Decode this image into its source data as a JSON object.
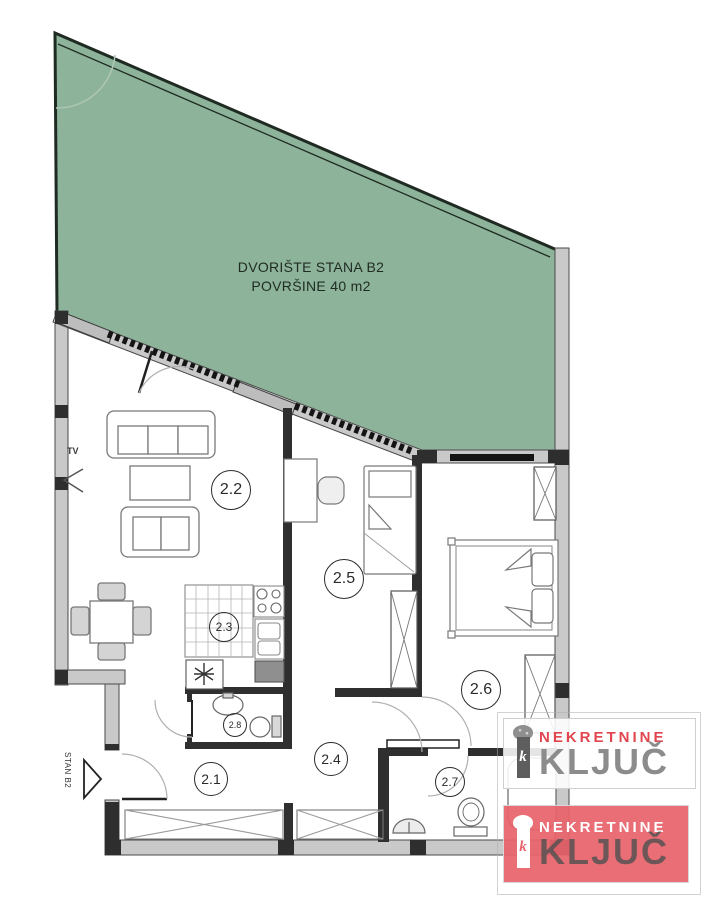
{
  "plan": {
    "type": "apartment-floor-plan",
    "background_color": "#ffffff",
    "wall_color": "#c9c9c9",
    "line_color": "#2f2f2f"
  },
  "courtyard": {
    "line1": "DVORIŠTE STANA B2",
    "line2": "POVRŠINE 40 m2",
    "fill_color": "#8db49a"
  },
  "entrance": {
    "label": "STAN B2",
    "arrow": "right-arrow"
  },
  "living_room": {
    "tv_label": "TV"
  },
  "rooms": [
    {
      "label": "2.1"
    },
    {
      "label": "2.2"
    },
    {
      "label": "2.3"
    },
    {
      "label": "2.4"
    },
    {
      "label": "2.5"
    },
    {
      "label": "2.6"
    },
    {
      "label": "2.7"
    },
    {
      "label": "2.8"
    }
  ],
  "watermarks": [
    {
      "style": "light",
      "line1": "NEKRETNINE",
      "line2": "KLJUČ",
      "icon": "key-icon",
      "icon_letter": "k",
      "accent_color": "#e2454e",
      "text_color": "#8c8c8c",
      "background": "#ffffff"
    },
    {
      "style": "red",
      "line1": "NEKRETNINE",
      "line2": "KLJUČ",
      "icon": "key-icon",
      "icon_letter": "k",
      "accent_color": "#ffffff",
      "text_color": "#6f6f6f",
      "background": "#e8636b"
    }
  ]
}
